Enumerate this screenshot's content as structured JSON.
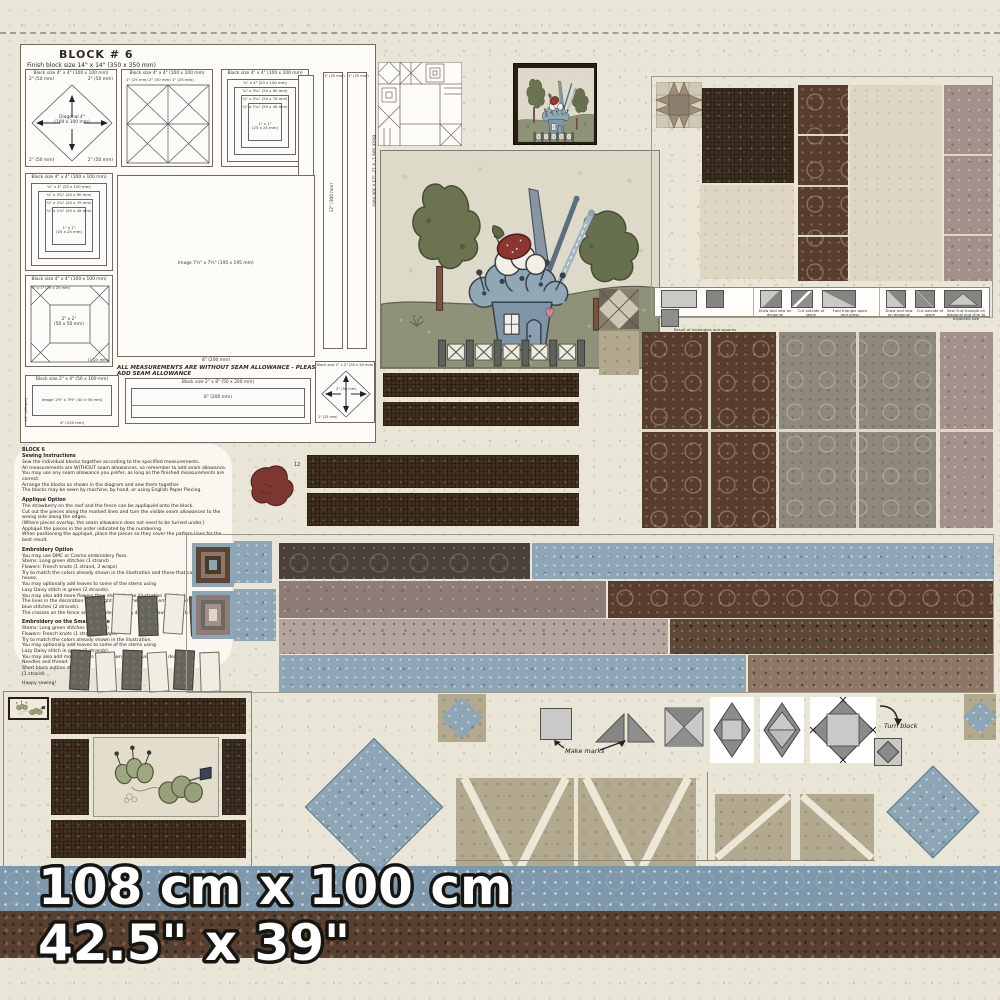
{
  "header": {
    "title": "BLOCK # 6",
    "subtitle": "Finish block size 14\" x 14\"  (350 x 350 mm)"
  },
  "measurements_note": "ALL MEASUREMENTS ARE WITHOUT SEAM ALLOWANCE - PLEASE ADD SEAM ALLOWANCE",
  "diagrams": {
    "d1": {
      "caption": "Block size 4\" x 4\"  (100 x 100 mm)",
      "center": "Diagonal 4\"\n(100 x 100 mm)",
      "tl": "2\" (50 mm)",
      "tr": "2\" (50 mm)",
      "bl": "2\" (50 mm)",
      "br": "2\" (50 mm)"
    },
    "d2": {
      "caption": "Block size 4\" x 4\"  (100 x 100 mm)",
      "labels": "1\" (25 mm)    2\" (50 mm)    1\" (25 mm)"
    },
    "d3": {
      "caption": "Block size 4\" x 4\"  (100 x 100 mm)",
      "r1": "¾\" x 4\"  (20 x 100 mm)",
      "r2": "¾\" x 3¾\"  (20 x 90 mm)",
      "r3": "¾\" x 2¾\"  (20 x 70 mm)",
      "r4": "¾\" x 1¾\"  (20 x 45 mm)",
      "c": "1\" x 1\"\n(25 x 25 mm)"
    },
    "d4": {
      "caption": "Block size 4\" x 4\"  (100 x 100 mm)",
      "r1": "¾\" x 4\"  (20 x 100 mm)",
      "r2": "¾\" x 3¾\"  (20 x 90 mm)",
      "r3": "¾\" x 2¾\"  (20 x 70 mm)",
      "r4": "¾\" x 1¾\"  (20 x 45 mm)",
      "c": "1\" x 1\"\n(25 x 25 mm)"
    },
    "d5": {
      "caption": "Block size 4\" x 4\"  (100 x 100 mm)",
      "corner": "1\" x 1\" (25 x 25 mm)",
      "center": "2\" x 2\"\n(50 x 50 mm)",
      "edge": "1\" (25 mm)"
    },
    "d6": {
      "center": "Image  7¾\" x 7¾\"  (195 x 195 mm)",
      "bottom": "8\"  (200 mm)"
    },
    "d7": {
      "caption": "Block size 2\" x 4\"  (50 x 100 mm)",
      "center": "Image  1½\" x 3½\"  (40 x 90 mm)",
      "bottom": "4\"  (100 mm)",
      "side": "1½\" (40 mm)"
    },
    "d8": {
      "caption": "Block size 2\" x 8\"  (50 x 200 mm)",
      "center": "8\"  (200 mm)"
    },
    "d9": {
      "caption": "Block size 2\" x 2\"  (50 x 50 mm)",
      "center": "2\" (50 mm)",
      "corner": "1\" (25 mm)"
    },
    "d10": {
      "caption": "Block size 1\" x 12\"  (25 x 300 mm)",
      "top_a": "1\" (25 mm)",
      "top_b": "1\" (25 mm)",
      "center": "12\"  (300 mm)"
    }
  },
  "applique": {
    "piece_number": "12"
  },
  "instructions": {
    "title": "BLOCK 6",
    "s1_heading": "Sewing Instructions",
    "s1_lines": "Sew the individual blocks together according to the specified measurements.\nAll measurements are WITHOUT seam allowances, so remember to add seam allowance.\nYou may use any seam allowance you prefer, as long as the finished measurements are correct.\nArrange the blocks as shown in the diagram and sew them together.\nThe blocks may be sewn by machine, by hand, or using English Paper Piecing.",
    "s2_heading": "Appliqué Option",
    "s2_lines": "The strawberry on the roof and the fence can be appliquéd onto the block.\nCut out the pieces along the marked lines and turn the visible seam allowances to the wrong side along the edges.\n(Where pieces overlap, the seam allowance does not need to be turned under.)\nAppliqué the pieces in the order indicated by the numbering.\nWhen positioning the appliqué, place the pieces so they cover the pattern lines for the best result.",
    "s3_heading": "Embroidery Option",
    "s3_lines": "You may use DMC or Cosmo embroidery floss.\nStems: Long green stitches (1 strand)\nFlowers: French knots (1 strand, 3 wraps)\nTry to match the colors already shown in the illustration and those that complement the house.\nYou may optionally add leaves to some of the stems using\nLazy Daisy stitch in green (2 strands).\nYou may also add more flowers than shown in the illustration if desired.\nThe lines in the decoration on the right side of the roof are embroidered using long dark blue stitches (2 strands).\nThe crosses on the fence are embroidered using dark blue outline stitch (2 strands).",
    "s4_heading": "Embroidery on the Small Picture",
    "s4_lines": "Stems: Long green stitches (1 strand)\nFlowers: French knots (1 strand, 3 wraps)\nTry to match the colors already shown in the illustration.\nYou may optionally add leaves to some of the stems using\nLazy Daisy stitch in green (2 strands).\nYou may also add more flowers than shown in the illustration if desired.\nNeedles and thread:\nShort black outline stitches\n(1 strand)",
    "closing": "Happy sewing!"
  },
  "construction": {
    "c1": "Result of rectangles and squares",
    "c2": "Draw and sew on diagonal",
    "c3": "Cut outside of seam",
    "c4": "Fold triangle open and press",
    "c5": "Draw and sew on diagonal",
    "c6": "Cut outside of seam",
    "c7": "Sew 2nd triangle on diagonal and trim to expected size"
  },
  "assembly": {
    "make_marks": "Make marks",
    "turn_block": "Turn block"
  },
  "banner": {
    "metric": "108 cm x 100 cm",
    "imperial": "42.5\" x 39\""
  },
  "colors": {
    "banner_blue": "#7e98ab",
    "banner_brown": "#57402f",
    "cream": "#e9e5d7",
    "dark_brown": "#3f2f20",
    "slate_blue": "#7e95a7",
    "strawberry_red": "#8c3531",
    "olive_green": "#6b7351"
  }
}
